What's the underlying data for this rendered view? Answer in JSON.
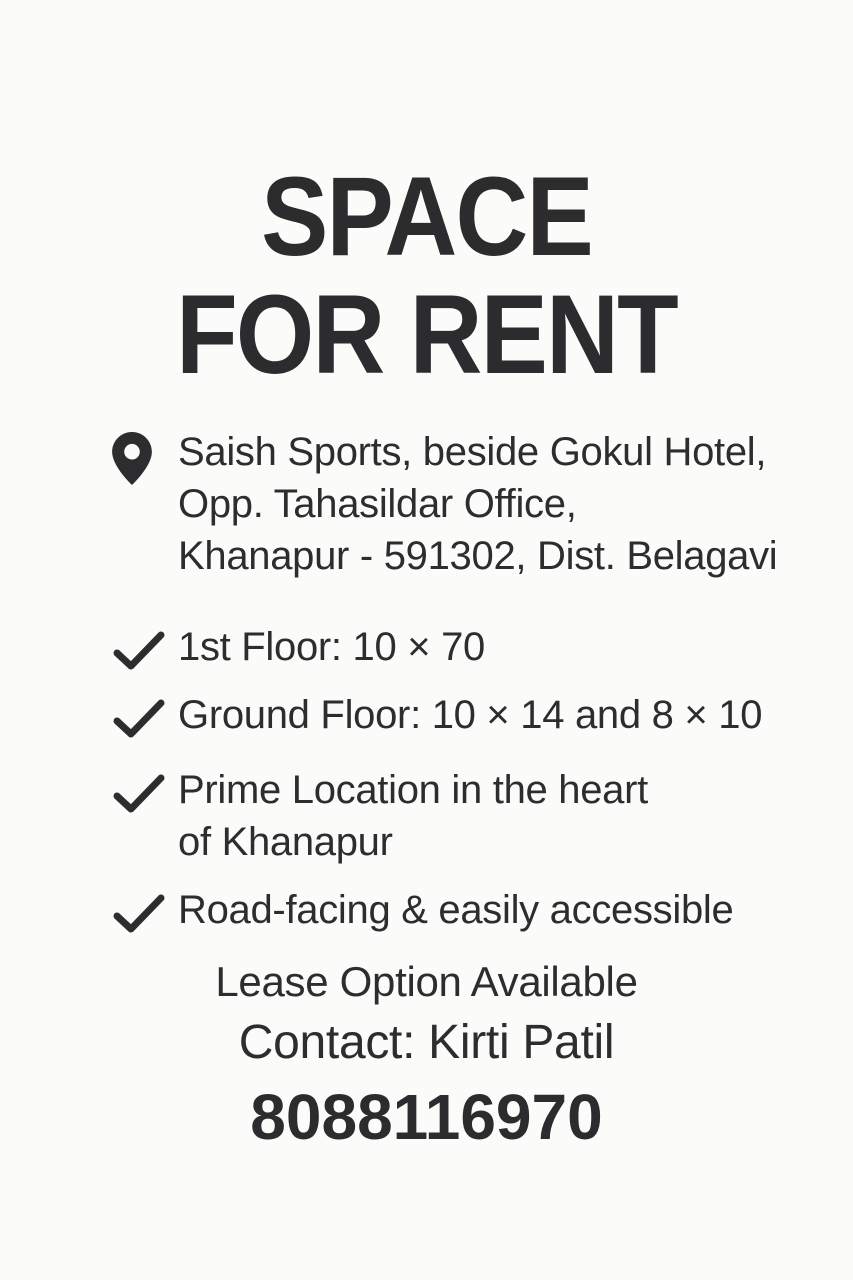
{
  "poster": {
    "title": {
      "line1": "SPACE",
      "line2": "FOR RENT"
    },
    "address": {
      "icon": "location-pin-icon",
      "line1": "Saish Sports, beside Gokul Hotel,",
      "line2": "Opp. Tahasildar Office,",
      "line3": "Khanapur - 591302, Dist. Belagavi"
    },
    "features": [
      {
        "icon": "checkmark-icon",
        "line1": "1st Floor: 10 × 70"
      },
      {
        "icon": "checkmark-icon",
        "line1": "Ground Floor: 10 × 14 and 8 × 10"
      },
      {
        "icon": "checkmark-icon",
        "line1": "Prime Location in the heart",
        "line2": "of Khanapur"
      },
      {
        "icon": "checkmark-icon",
        "line1": "Road-facing & easily accessible"
      }
    ],
    "footer": {
      "lease_note": "Lease Option Available",
      "contact": "Contact: Kirti Patil",
      "phone": "8088116970"
    },
    "colors": {
      "text": "#2d2d2f",
      "background": "#fbfbfa"
    }
  }
}
